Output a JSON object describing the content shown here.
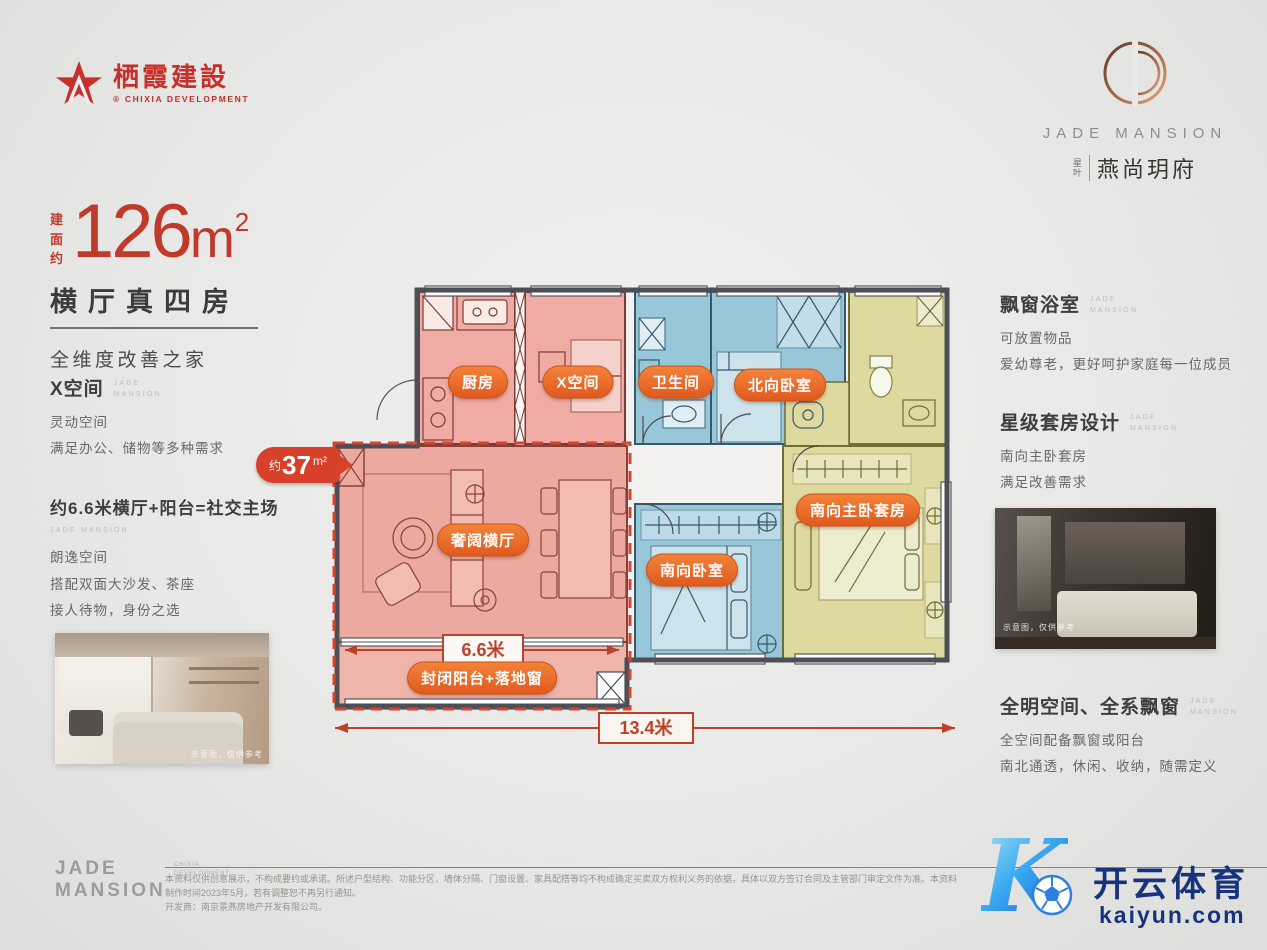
{
  "brand_header": {
    "chixia_logo_text": "栖霞建設",
    "chixia_logo_sub": "® CHIXIA DEVELOPMENT",
    "jade_mansion": "JADE MANSION",
    "project_tag_line1": "星",
    "project_tag_line2": "叶",
    "project_name": "燕尚玥府"
  },
  "headline": {
    "area_label": "建面约",
    "area_number": "126",
    "area_unit": "m",
    "area_sup": "2",
    "title": "横厅真四房",
    "subtitle": "全维度改善之家"
  },
  "brand_small": {
    "line1": "JADE",
    "line2": "MANSION"
  },
  "left_column": {
    "section1": {
      "title": "X空间",
      "lines": [
        "灵动空间",
        "满足办公、储物等多种需求"
      ]
    },
    "section2": {
      "title": "约6.6米横厅+阳台=社交主场",
      "lines": [
        "朗逸空间",
        "搭配双面大沙发、茶座",
        "接人待物，身份之选"
      ]
    },
    "photo_caption": "示意图，仅供参考"
  },
  "right_column": {
    "section1": {
      "title": "飘窗浴室",
      "lines": [
        "可放置物品",
        "爱幼尊老，更好呵护家庭每一位成员"
      ]
    },
    "section2": {
      "title": "星级套房设计",
      "lines": [
        "南向主卧套房",
        "满足改善需求"
      ]
    },
    "photo_caption": "示意图，仅供参考",
    "section3": {
      "title": "全明空间、全系飘窗",
      "lines": [
        "全空间配备飘窗或阳台",
        "南北通透，休闲、收纳，随需定义"
      ]
    }
  },
  "floorplan": {
    "rooms": {
      "kitchen": "厨房",
      "x_space": "X空间",
      "bathroom": "卫生间",
      "north_bedroom": "北向卧室",
      "living": "奢阔横厅",
      "south_bedroom": "南向卧室",
      "master_suite": "南向主卧套房",
      "balcony": "封闭阳台+落地窗"
    },
    "area_badge": {
      "prefix": "约",
      "value": "37",
      "unit": "m²"
    },
    "dim_width": "6.6米",
    "dim_total": "13.4米",
    "colors": {
      "pink_room": "#f0aca4",
      "blue_room": "#99c7da",
      "yellow_room": "#ded99f",
      "badge_orange": "#e8672b",
      "dashed_red": "#d7452c"
    }
  },
  "footer": {
    "logo_line1": "JADE",
    "logo_line2": "MANSION",
    "logo_sub1": "CHIXIA",
    "logo_sub2": "DEVELOPMENT",
    "disclaimer_line1": "本资料仅供创意展示，不构成要约或承诺。所述户型结构、功能分区、墙体分隔、门窗设置、家具配搭等均不构成确定买卖双方权利义务的依据，具体以双方签订合同及主管部门审定文件为准。本资料制作时间2023年5月，若有调整恕不再另行通知。",
    "disclaimer_line2": "开发商：南京景燕房地产开发有限公司。"
  },
  "watermark": {
    "cn": "开云体育",
    "domain": "kaiyun.com",
    "letter": "K"
  }
}
